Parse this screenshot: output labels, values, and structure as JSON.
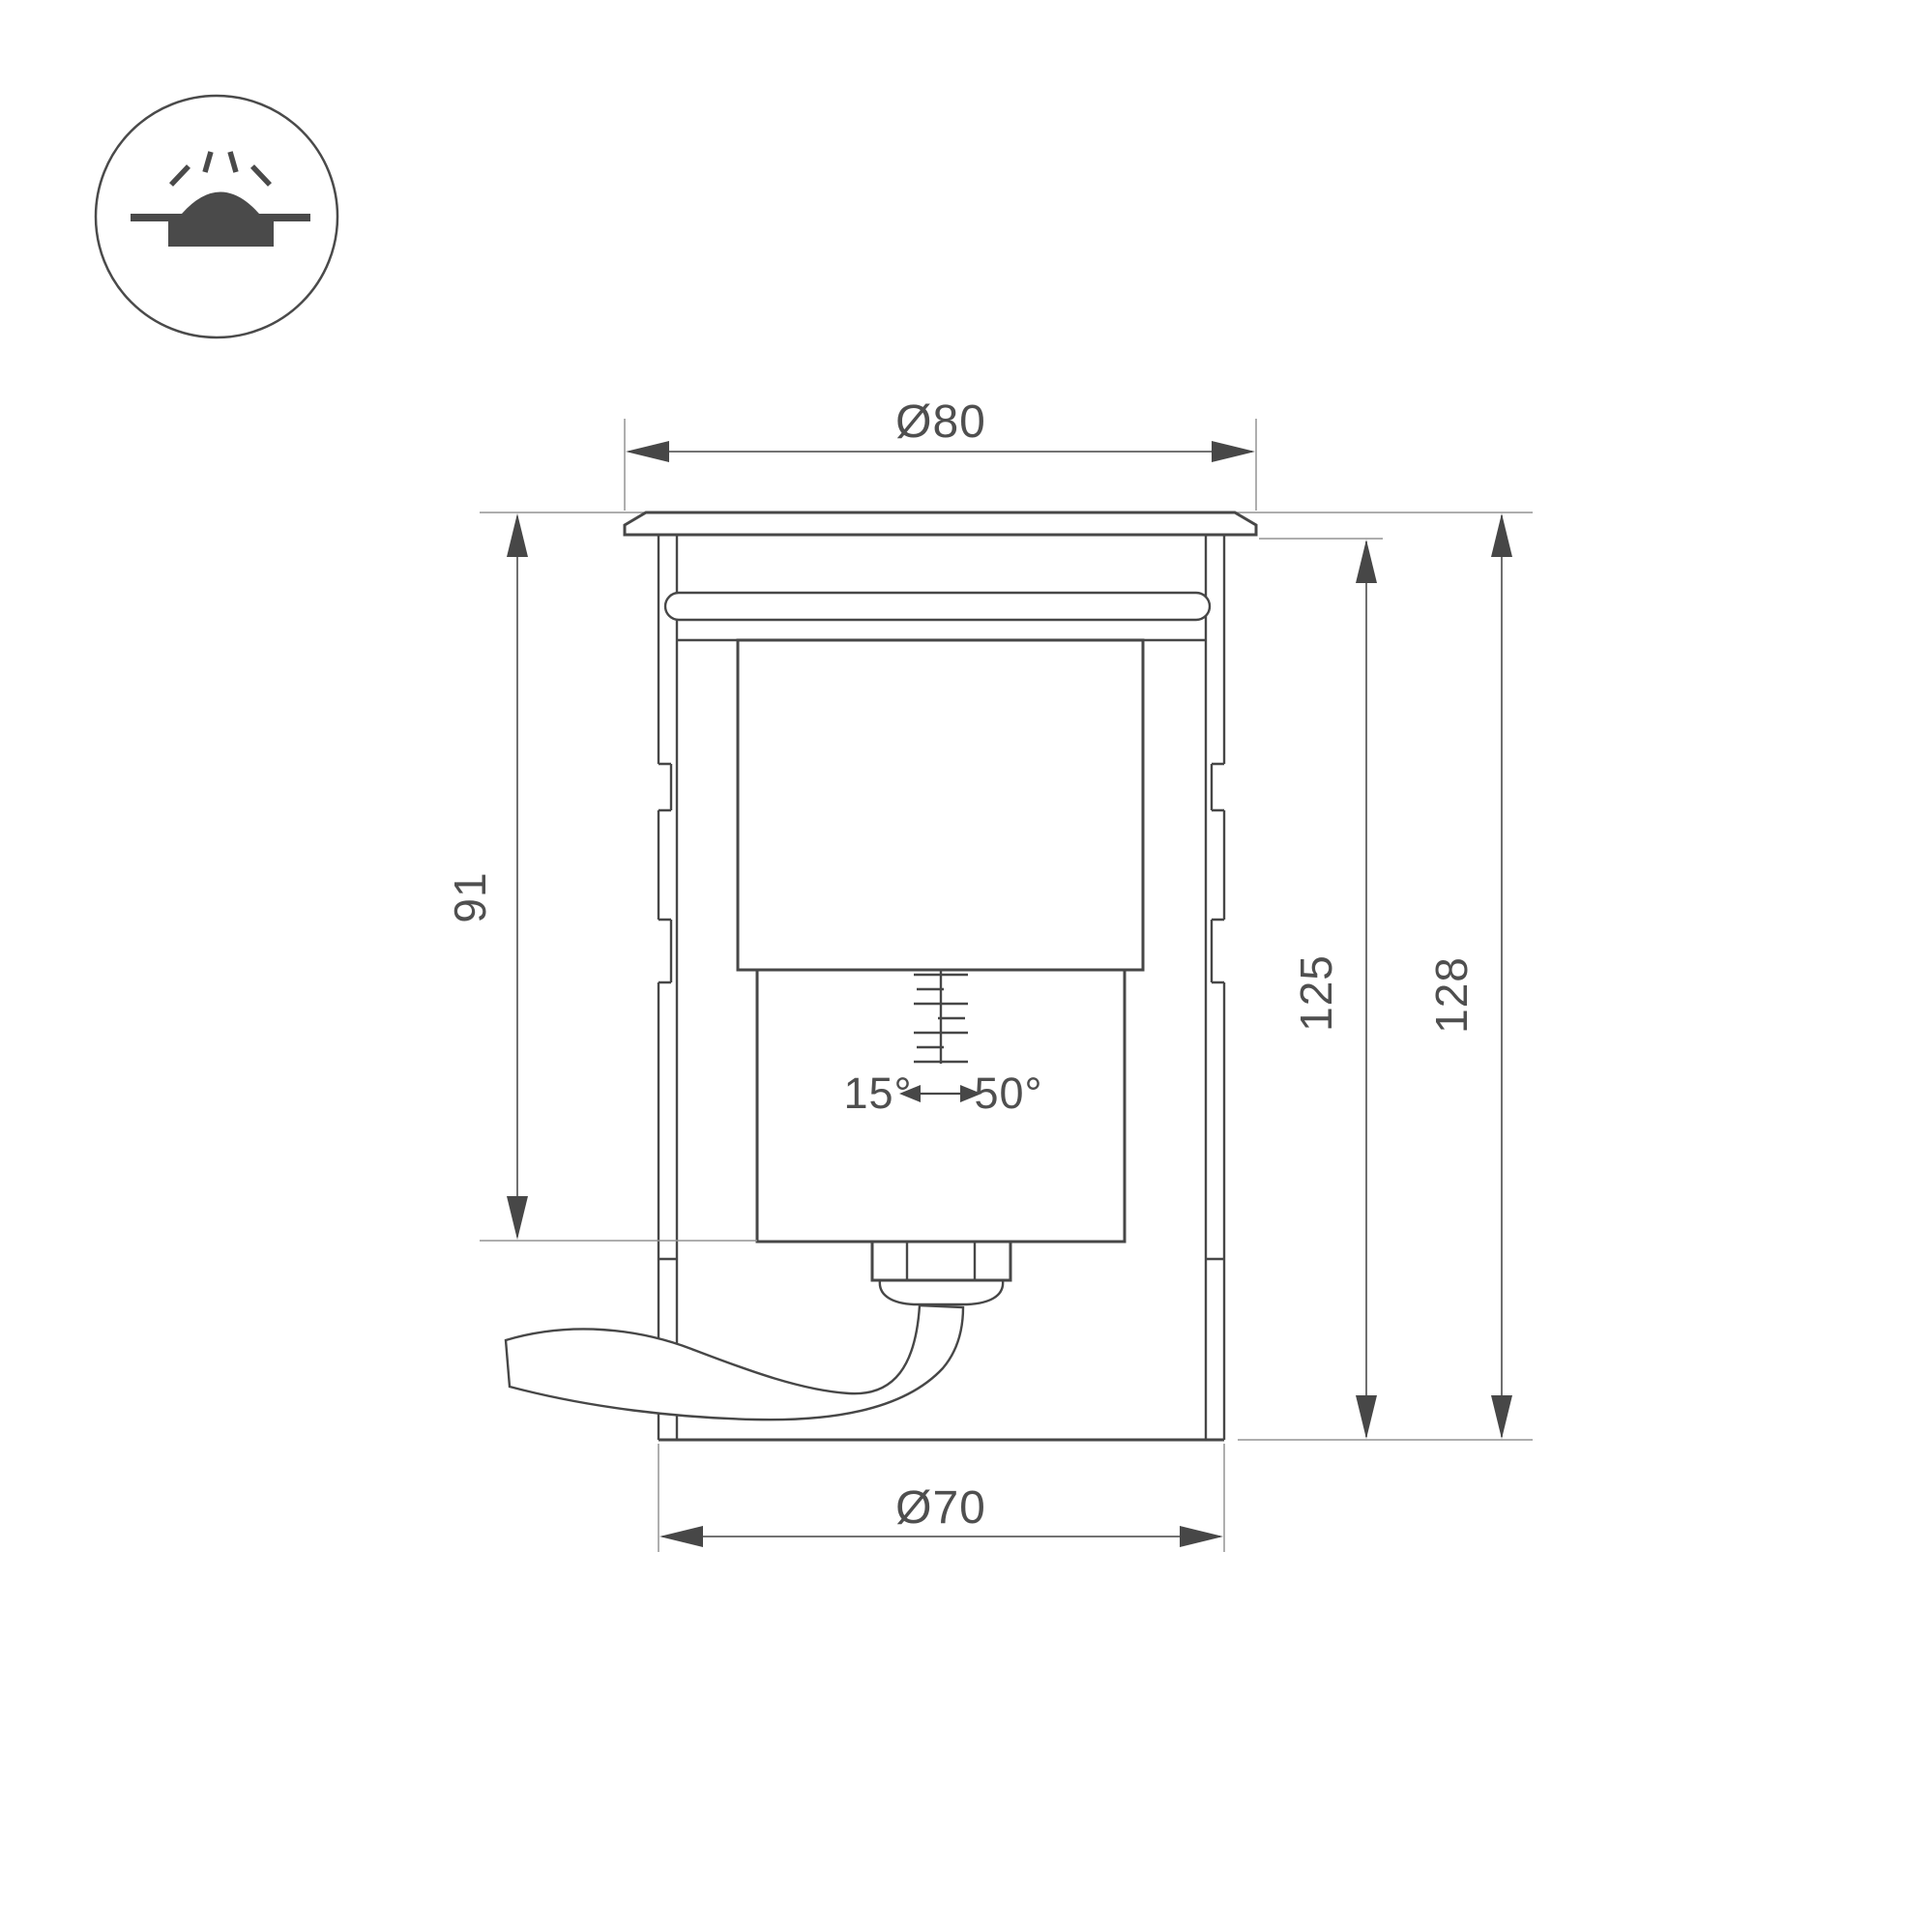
{
  "drawing": {
    "type": "technical-dimension-drawing",
    "subject": "recessed in-ground luminaire, side section view",
    "colors": {
      "background": "#ffffff",
      "object_line": "#474747",
      "thin_line": "#949494",
      "dimension_line": "#5f5f5f",
      "text": "#4f4f4f"
    },
    "icon": {
      "name": "recessed-ground-light-icon",
      "description": "dome light recessed in ground with rays"
    },
    "dims": {
      "top_diameter": "Ø80",
      "bottom_diameter": "Ø70",
      "recess_depth": "91",
      "body_height": "125",
      "overall_height": "128",
      "tilt_min": "15°",
      "tilt_max": "50°"
    }
  }
}
